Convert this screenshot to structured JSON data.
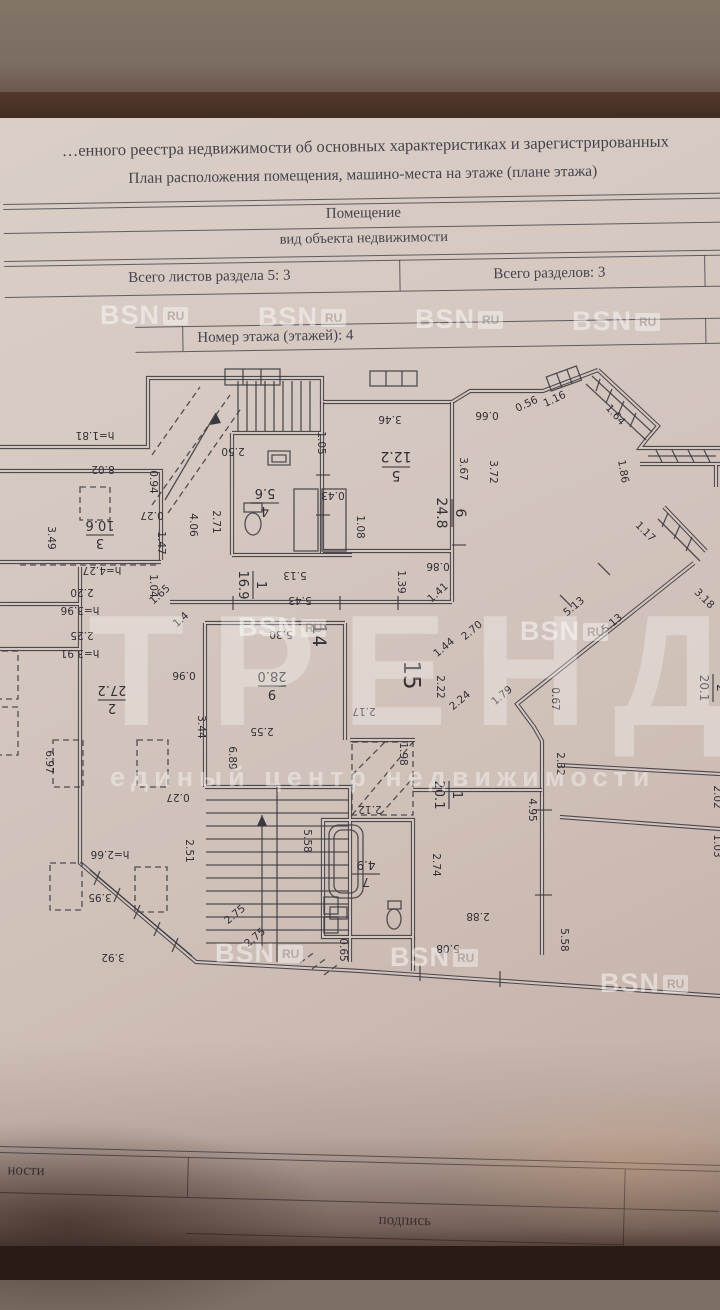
{
  "header": {
    "line1": "…енного реестра недвижимости об основных характеристиках и зарегистрированных",
    "line2": "План расположения помещения, машино-места на этаже (плане этажа)",
    "object_type": "Помещение",
    "object_type_caption": "вид объекта недвижимости",
    "sheets_total": "Всего листов раздела 5: 3",
    "sections_total": "Всего разделов: 3",
    "floor_number": "Номер этажа (этажей): 4"
  },
  "footer": {
    "left_partial": "ности",
    "signature_label": "подпись",
    "stamp_label": "М.П."
  },
  "watermarks": {
    "bsn_text": "BSN",
    "bsn_suffix": "RU",
    "brand": "ТРЕНД",
    "brand_sub": "единый центр недвижимости",
    "bsn_positions": [
      [
        100,
        300
      ],
      [
        258,
        302
      ],
      [
        415,
        304
      ],
      [
        572,
        306
      ],
      [
        238,
        612
      ],
      [
        520,
        616
      ],
      [
        215,
        938
      ],
      [
        390,
        942
      ],
      [
        600,
        968
      ]
    ]
  },
  "floor_plan": {
    "rooms": [
      {
        "n": "1",
        "a": "16.9",
        "x": 253,
        "y": 230,
        "r": 90,
        "s": 13
      },
      {
        "n": "4",
        "a": "5.6",
        "x": 265,
        "y": 148,
        "r": 180,
        "s": 13
      },
      {
        "n": "5",
        "a": "12.2",
        "x": 396,
        "y": 112,
        "r": 180,
        "s": 14
      },
      {
        "n": "6",
        "a": "24.8",
        "x": 452,
        "y": 158,
        "r": 90,
        "s": 14
      },
      {
        "n": "3",
        "a": "10.6",
        "x": 100,
        "y": 180,
        "r": 180,
        "s": 13
      },
      {
        "n": "2",
        "a": "27.2",
        "x": 112,
        "y": 345,
        "r": 180,
        "s": 13
      },
      {
        "n": "9",
        "a": "28.0",
        "x": 272,
        "y": 331,
        "r": 180,
        "s": 13
      },
      {
        "n": "1",
        "a": "20.1",
        "x": 449,
        "y": 440,
        "r": 90,
        "s": 13
      },
      {
        "n": "7",
        "a": "4.9",
        "x": 366,
        "y": 519,
        "r": 180,
        "s": 12
      },
      {
        "n": "2",
        "a": "20.1",
        "x": 713,
        "y": 333,
        "r": 90,
        "s": 12
      }
    ],
    "corridors": [
      {
        "n": "14",
        "x": 313,
        "y": 280,
        "r": 90,
        "s": 19
      },
      {
        "n": "15",
        "x": 404,
        "y": 320,
        "r": 90,
        "s": 23
      }
    ],
    "dimensions": [
      [
        "2.50",
        233,
        93,
        180
      ],
      [
        "1.05",
        318,
        88,
        90
      ],
      [
        "h=1.81",
        95,
        77,
        180
      ],
      [
        "8.02",
        103,
        111,
        180
      ],
      [
        "3.46",
        390,
        61,
        180
      ],
      [
        "0.66",
        487,
        57,
        180
      ],
      [
        "0.56",
        528,
        52,
        -25
      ],
      [
        "1.16",
        556,
        47,
        -25
      ],
      [
        "1.64",
        613,
        62,
        48
      ],
      [
        "3.49",
        48,
        183,
        90
      ],
      [
        "0.94",
        150,
        127,
        90
      ],
      [
        "0.27",
        152,
        157,
        180
      ],
      [
        "1.47",
        158,
        188,
        90
      ],
      [
        "4.06",
        190,
        170,
        90
      ],
      [
        "2.71",
        213,
        167,
        90
      ],
      [
        "3.67",
        460,
        114,
        90
      ],
      [
        "3.72",
        490,
        117,
        90
      ],
      [
        "1.86",
        620,
        117,
        80
      ],
      [
        "1.17",
        643,
        179,
        45
      ],
      [
        "0.43",
        333,
        137,
        180
      ],
      [
        "1.08",
        357,
        172,
        90
      ],
      [
        "h=4.27",
        102,
        212,
        180
      ],
      [
        "2.20",
        82,
        234,
        180
      ],
      [
        "h=3.96",
        80,
        252,
        180
      ],
      [
        "2.25",
        82,
        277,
        180
      ],
      [
        "h=3.91",
        80,
        295,
        180
      ],
      [
        "1.65",
        162,
        242,
        -42
      ],
      [
        "1.4",
        183,
        267,
        -42
      ],
      [
        "1.04",
        150,
        231,
        90
      ],
      [
        "5.13",
        295,
        217,
        180
      ],
      [
        "5.43",
        300,
        242,
        180
      ],
      [
        "5.30",
        281,
        276,
        180
      ],
      [
        "1.39",
        398,
        227,
        90
      ],
      [
        "0.86",
        438,
        208,
        180
      ],
      [
        "1.41",
        440,
        240,
        -42
      ],
      [
        "0.96",
        184,
        317,
        180
      ],
      [
        "3.44",
        198,
        372,
        90
      ],
      [
        "2.22",
        437,
        332,
        90
      ],
      [
        "2.24",
        462,
        348,
        -40
      ],
      [
        "1.79",
        504,
        343,
        -40
      ],
      [
        "0.67",
        552,
        344,
        90
      ],
      [
        "2.70",
        474,
        278,
        -40
      ],
      [
        "1.44",
        446,
        295,
        -40
      ],
      [
        "5.13",
        576,
        254,
        -40
      ],
      [
        "5.13",
        614,
        271,
        -40
      ],
      [
        "3.18",
        702,
        246,
        45
      ],
      [
        "2.17",
        364,
        353,
        180
      ],
      [
        "2.55",
        262,
        373,
        180
      ],
      [
        "6.89",
        229,
        403,
        90
      ],
      [
        "1.98",
        400,
        399,
        90
      ],
      [
        "2.12",
        370,
        451,
        180
      ],
      [
        "5.58",
        304,
        486,
        90
      ],
      [
        "2.51",
        186,
        496,
        90
      ],
      [
        "0.27",
        178,
        439,
        180
      ],
      [
        "6.97",
        46,
        407,
        90
      ],
      [
        "h=2.66",
        110,
        496,
        180
      ],
      [
        "3.95",
        100,
        539,
        180
      ],
      [
        "3.92",
        113,
        599,
        180
      ],
      [
        "2.75",
        237,
        562,
        -40
      ],
      [
        "2.75",
        257,
        585,
        -40
      ],
      [
        "0.65",
        340,
        595,
        90
      ],
      [
        "5.08",
        448,
        590,
        180
      ],
      [
        "2.88",
        478,
        558,
        180
      ],
      [
        "2.74",
        433,
        510,
        90
      ],
      [
        "4.95",
        529,
        455,
        90
      ],
      [
        "5.58",
        561,
        585,
        90
      ],
      [
        "2.32",
        557,
        409,
        90
      ],
      [
        "2.02",
        714,
        442,
        90
      ],
      [
        "1.03",
        714,
        491,
        90
      ]
    ]
  }
}
